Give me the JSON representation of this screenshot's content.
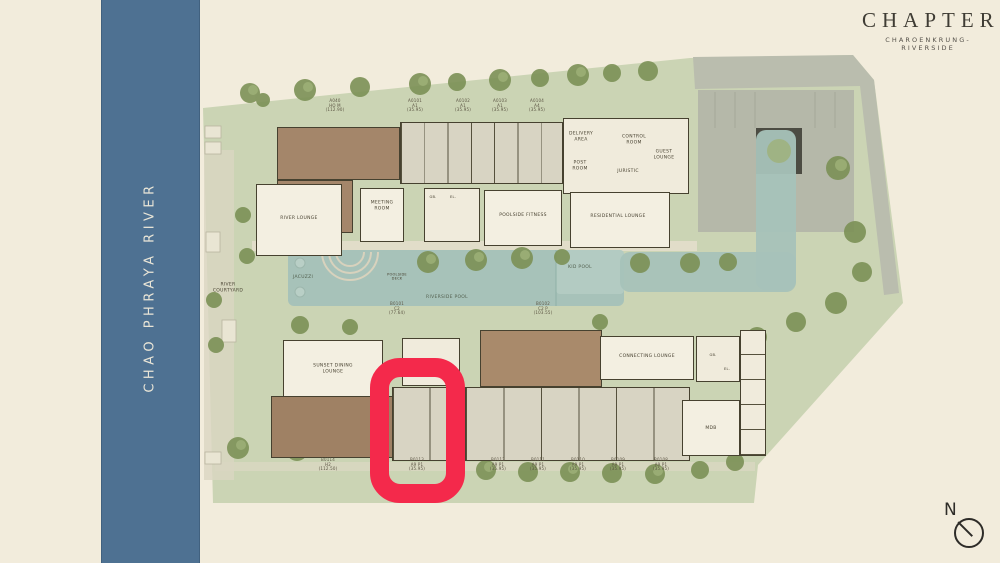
{
  "logo": {
    "title": "CHAPTER",
    "subtitle": "CHAROENKRUNG-RIVERSIDE"
  },
  "river_label": "CHAO PHRAYA RIVER",
  "compass_label": "N",
  "accent": {
    "highlight_red": "#F4294B",
    "river_blue": "#4E7192",
    "site_green": "#CBD4B4",
    "pool_aqua": "#A7C2B9"
  },
  "rooms": {
    "river_lounge": "RIVER LOUNGE",
    "meeting_room": "MEETING\nROOM",
    "gb": "GB.",
    "el": "EL.",
    "poolside_fitness": "POOLSIDE FITNESS",
    "residential_lounge": "RESIDENTIAL LOUNGE",
    "delivery_area": "DELIVERY\nAREA",
    "control_room": "CONTROL\nROOM",
    "guest_lounge": "GUEST\nLOUNGE",
    "post_room": "POST\nROOM",
    "juristic": "JURISTIC",
    "river_courtyard": "RIVER\nCOURTYARD",
    "jacuzzi": "JACUZZI",
    "poolside_deck": "POOLSIDE\nDECK",
    "riverside_pool": "RIVERSIDE POOL",
    "kid_pool": "KID POOL",
    "sunset_dining_lounge": "SUNSET DINING\nLOUNGE",
    "connecting_lounge": "CONNECTING LOUNGE",
    "mdb": "MDB"
  },
  "top_units": [
    {
      "id": "A040",
      "type": "HO M",
      "area": "(112.90)"
    },
    {
      "id": "A0101",
      "type": "A1",
      "area": "(35.95)"
    },
    {
      "id": "A0102",
      "type": "A1",
      "area": "(35.95)"
    },
    {
      "id": "A0103",
      "type": "A1",
      "area": "(35.95)"
    },
    {
      "id": "A0104",
      "type": "A4",
      "area": "(35.95)"
    }
  ],
  "pool_units": [
    {
      "id": "B0101",
      "type": "C2",
      "area": "(77.64)"
    },
    {
      "id": "B0102",
      "type": "C2 P",
      "area": "(103.55)"
    }
  ],
  "bottom_units": [
    {
      "id": "B0114",
      "type": "H2",
      "area": "(112.50)",
      "highlighted": false
    },
    {
      "id": "B0113",
      "type": "A9 P1",
      "area": "(35.95)",
      "highlighted": true
    },
    {
      "id": "B0112",
      "type": "A9 P1",
      "area": "(35.95)",
      "highlighted": false
    },
    {
      "id": "B0111",
      "type": "A9 P1",
      "area": "(35.95)",
      "highlighted": false
    },
    {
      "id": "B0110",
      "type": "A9 P1",
      "area": "(35.95)",
      "highlighted": false
    },
    {
      "id": "B0109",
      "type": "A9 P1",
      "area": "(35.95)",
      "highlighted": false
    },
    {
      "id": "B0108",
      "type": "A9 P1",
      "area": "(35.95)",
      "highlighted": false
    }
  ]
}
